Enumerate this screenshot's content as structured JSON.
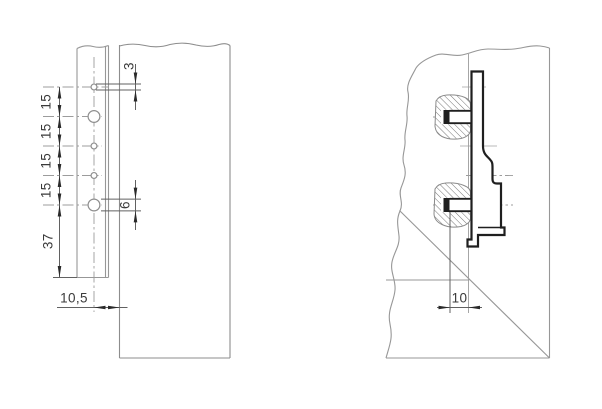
{
  "drawing": {
    "type": "technical-dimension-drawing",
    "units_style": "metric-decimal-comma",
    "front_view": {
      "hole_pitch_labels": [
        "15",
        "15",
        "15",
        "15"
      ],
      "bottom_offset_label": "37",
      "small_hole_diameter_label": "3",
      "large_hole_diameter_label": "6",
      "edge_distance_label": "10,5"
    },
    "section_view": {
      "drilling_distance_label": "10"
    },
    "colors": {
      "background": "#ffffff",
      "geometry_line": "#979797",
      "profile_line": "#1f1f1f",
      "dimension_line": "#616161",
      "arrow": "#2a2a2a",
      "reference_line": "#b9b9b9",
      "hatch": "#767676",
      "text": "#3a3a3a"
    }
  }
}
